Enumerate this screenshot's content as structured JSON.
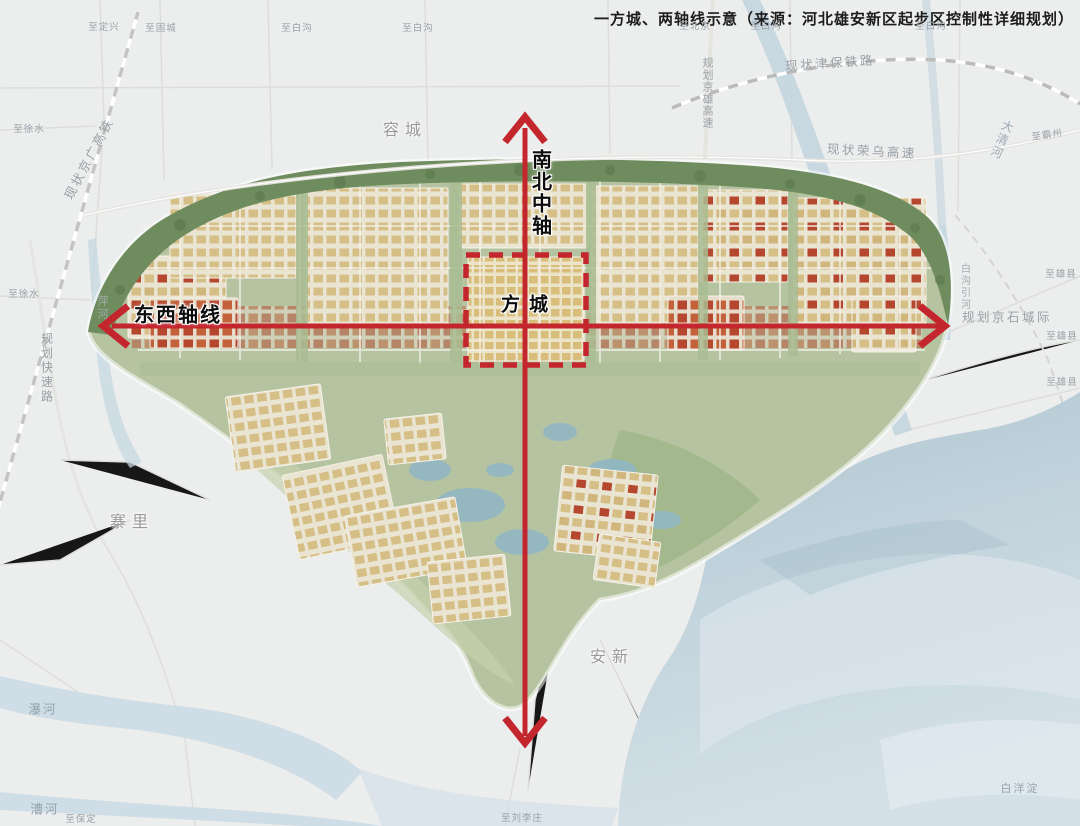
{
  "title": "一方城、两轴线示意（来源：河北雄安新区起步区控制性详细规划）",
  "axes": {
    "north_south_label": "南北中轴",
    "east_west_label": "东西轴线",
    "fangcheng_label": "方城"
  },
  "places": {
    "rongcheng": "容城",
    "anxin": "安新",
    "zhaili": "寨里",
    "baiyangdian": "白洋淀"
  },
  "waterways": {
    "daqinghe": "大清河",
    "pinghe": "萍河",
    "puhe": "瀑河",
    "caohe": "漕河",
    "baigouyinhe": "白沟引河"
  },
  "infrastructure": {
    "jinbao_railway": "现状津保铁路",
    "jingxiong_expressway": "规划京雄高速",
    "rongwu_expressway": "现状荣乌高速",
    "jingguang_hsr": "现状京广高铁",
    "jingshi_intercity": "规划京石城际",
    "planned_expressway": "规划快速路"
  },
  "edge_labels": [
    "至定兴",
    "至固城",
    "至白沟",
    "至白沟",
    "至北京",
    "至白沟",
    "至白沟",
    "至霸州",
    "至徐水",
    "至徐水",
    "至保定",
    "至刘李庄",
    "至雄县",
    "至雄县",
    "至雄县"
  ],
  "colors": {
    "axis_red": "#c4262e",
    "water_blue": "#c9d9e2",
    "greenbelt": "#6f8c5e",
    "urban_tan": "#d5bf86",
    "urban_red": "#b5472e"
  }
}
